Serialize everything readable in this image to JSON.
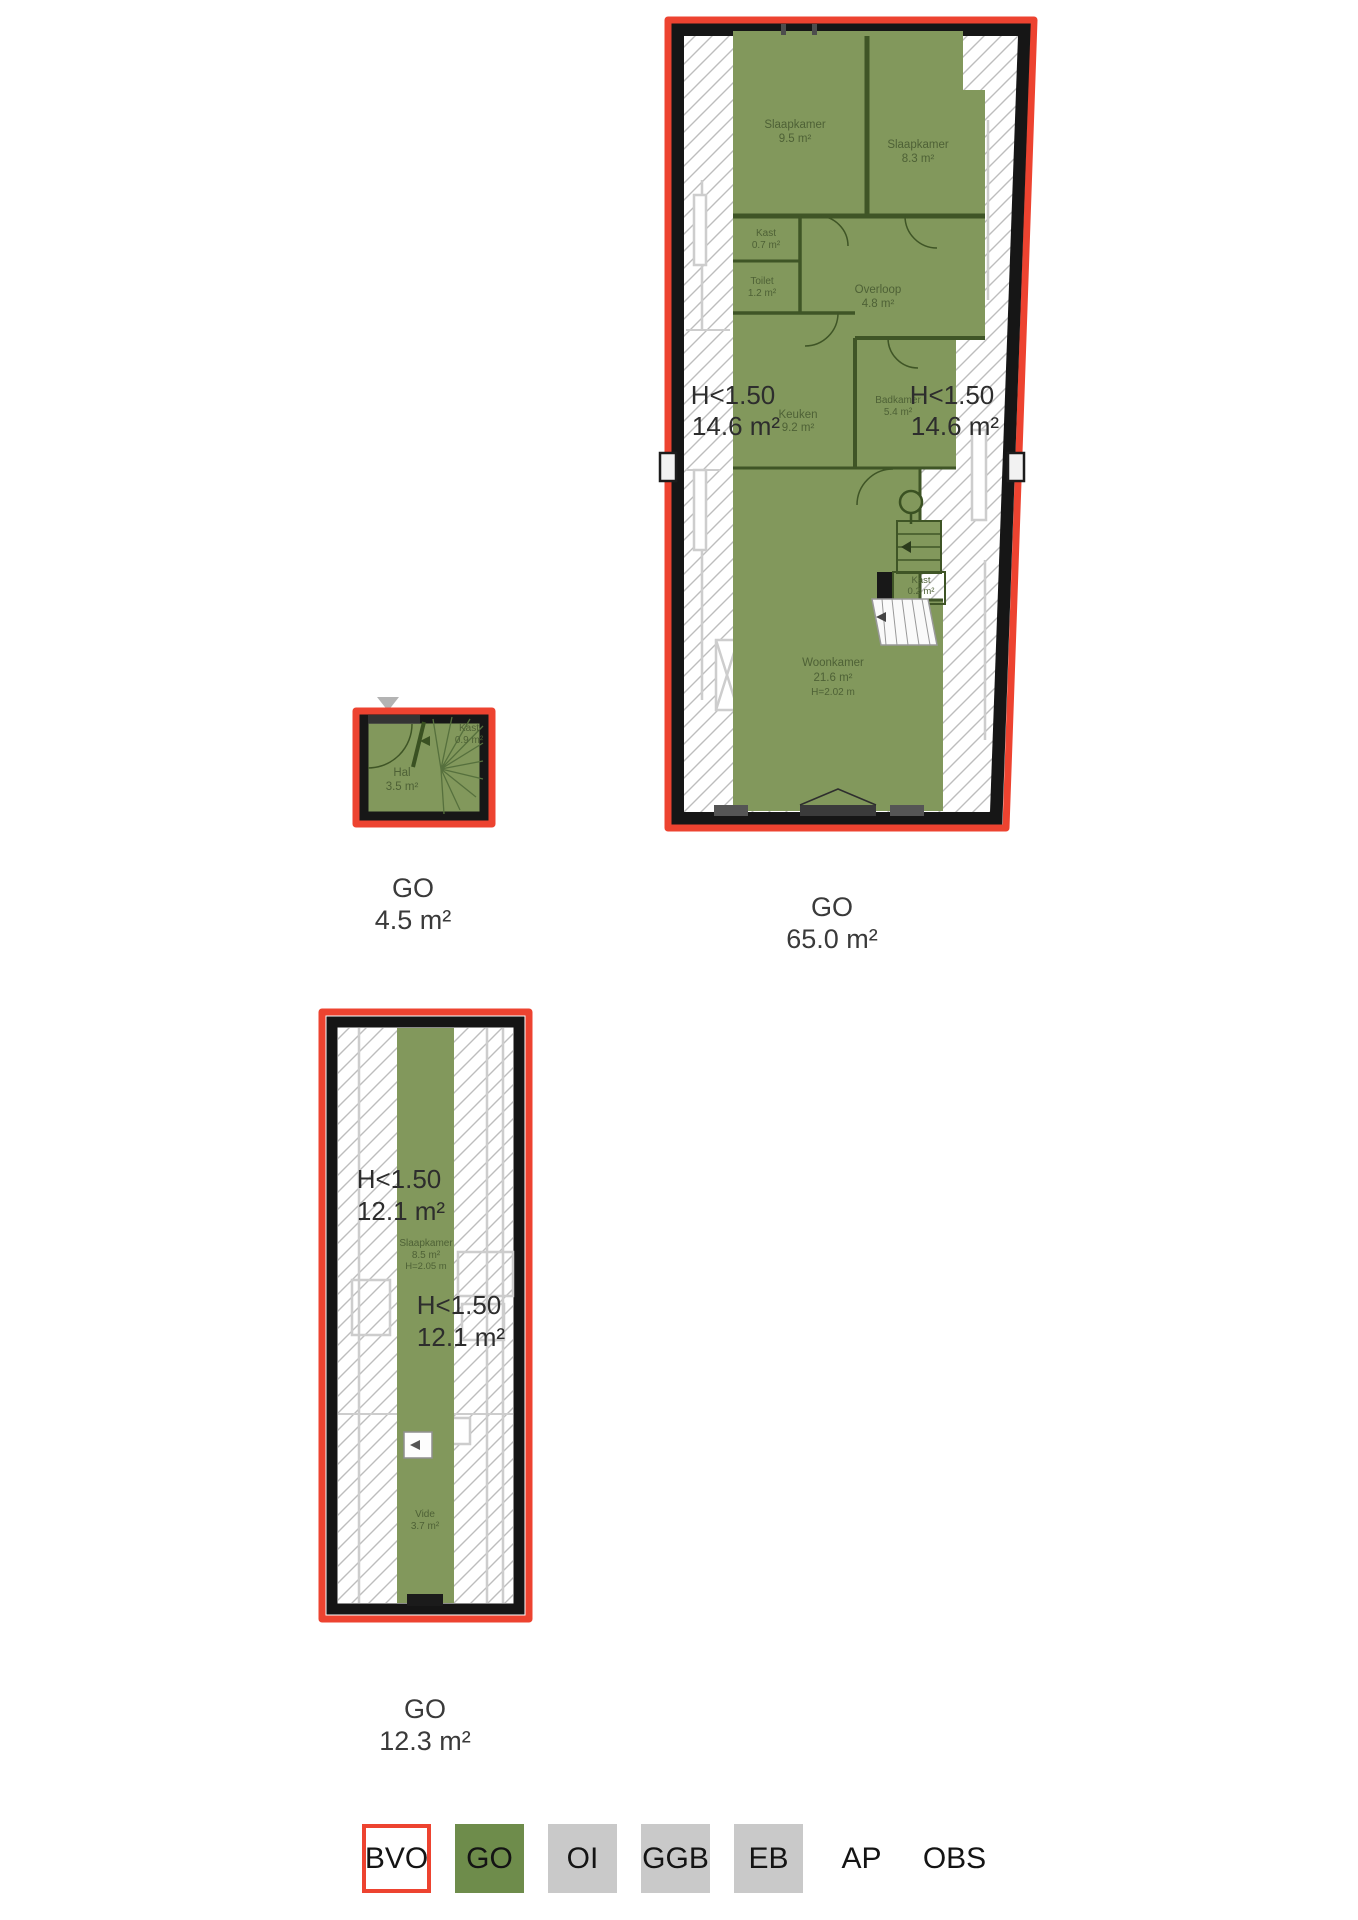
{
  "colors": {
    "outline_red": "#ed4330",
    "legend_green": "#6e8c4b",
    "plan_green": "#82985c",
    "legend_gray": "#c9c9c9"
  },
  "plans": {
    "first_floor": {
      "go_label": "GO",
      "go_area": "65.0 m²",
      "low_left": {
        "label": "H<1.50",
        "area": "14.6 m²"
      },
      "low_right": {
        "label": "H<1.50",
        "area": "14.6 m²"
      },
      "rooms": {
        "slaapkamer_1": {
          "name": "Slaapkamer",
          "area": "9.5 m²"
        },
        "slaapkamer_2": {
          "name": "Slaapkamer",
          "area": "8.3 m²"
        },
        "kast_1": {
          "name": "Kast",
          "area": "0.7 m²"
        },
        "toilet": {
          "name": "Toilet",
          "area": "1.2 m²"
        },
        "overloop": {
          "name": "Overloop",
          "area": "4.8 m²"
        },
        "badkamer": {
          "name": "Badkamer",
          "area": "5.4 m²"
        },
        "keuken": {
          "name": "Keuken",
          "area": "9.2 m²"
        },
        "kast_2": {
          "name": "Kast",
          "area": "0.2 m²"
        },
        "woonkamer": {
          "name": "Woonkamer",
          "area": "21.6 m²",
          "height": "H=2.02 m"
        }
      }
    },
    "ground_floor": {
      "go_label": "GO",
      "go_area": "4.5 m²",
      "rooms": {
        "kast": {
          "name": "Kast",
          "area": "0.9 m²"
        },
        "hal": {
          "name": "Hal",
          "area": "3.5 m²"
        }
      }
    },
    "attic": {
      "go_label": "GO",
      "go_area": "12.3 m²",
      "low_upper": {
        "label": "H<1.50",
        "area": "12.1 m²"
      },
      "low_lower": {
        "label": "H<1.50",
        "area": "12.1 m²"
      },
      "rooms": {
        "slaapkamer": {
          "name": "Slaapkamer",
          "area": "8.5 m²",
          "height": "H=2.05 m"
        },
        "vide": {
          "name": "Vide",
          "area": "3.7 m²"
        }
      }
    }
  },
  "legend": {
    "items": [
      {
        "label": "BVO"
      },
      {
        "label": "GO"
      },
      {
        "label": "OI"
      },
      {
        "label": "GGB"
      },
      {
        "label": "EB"
      },
      {
        "label": "AP"
      },
      {
        "label": "OBS"
      }
    ]
  }
}
